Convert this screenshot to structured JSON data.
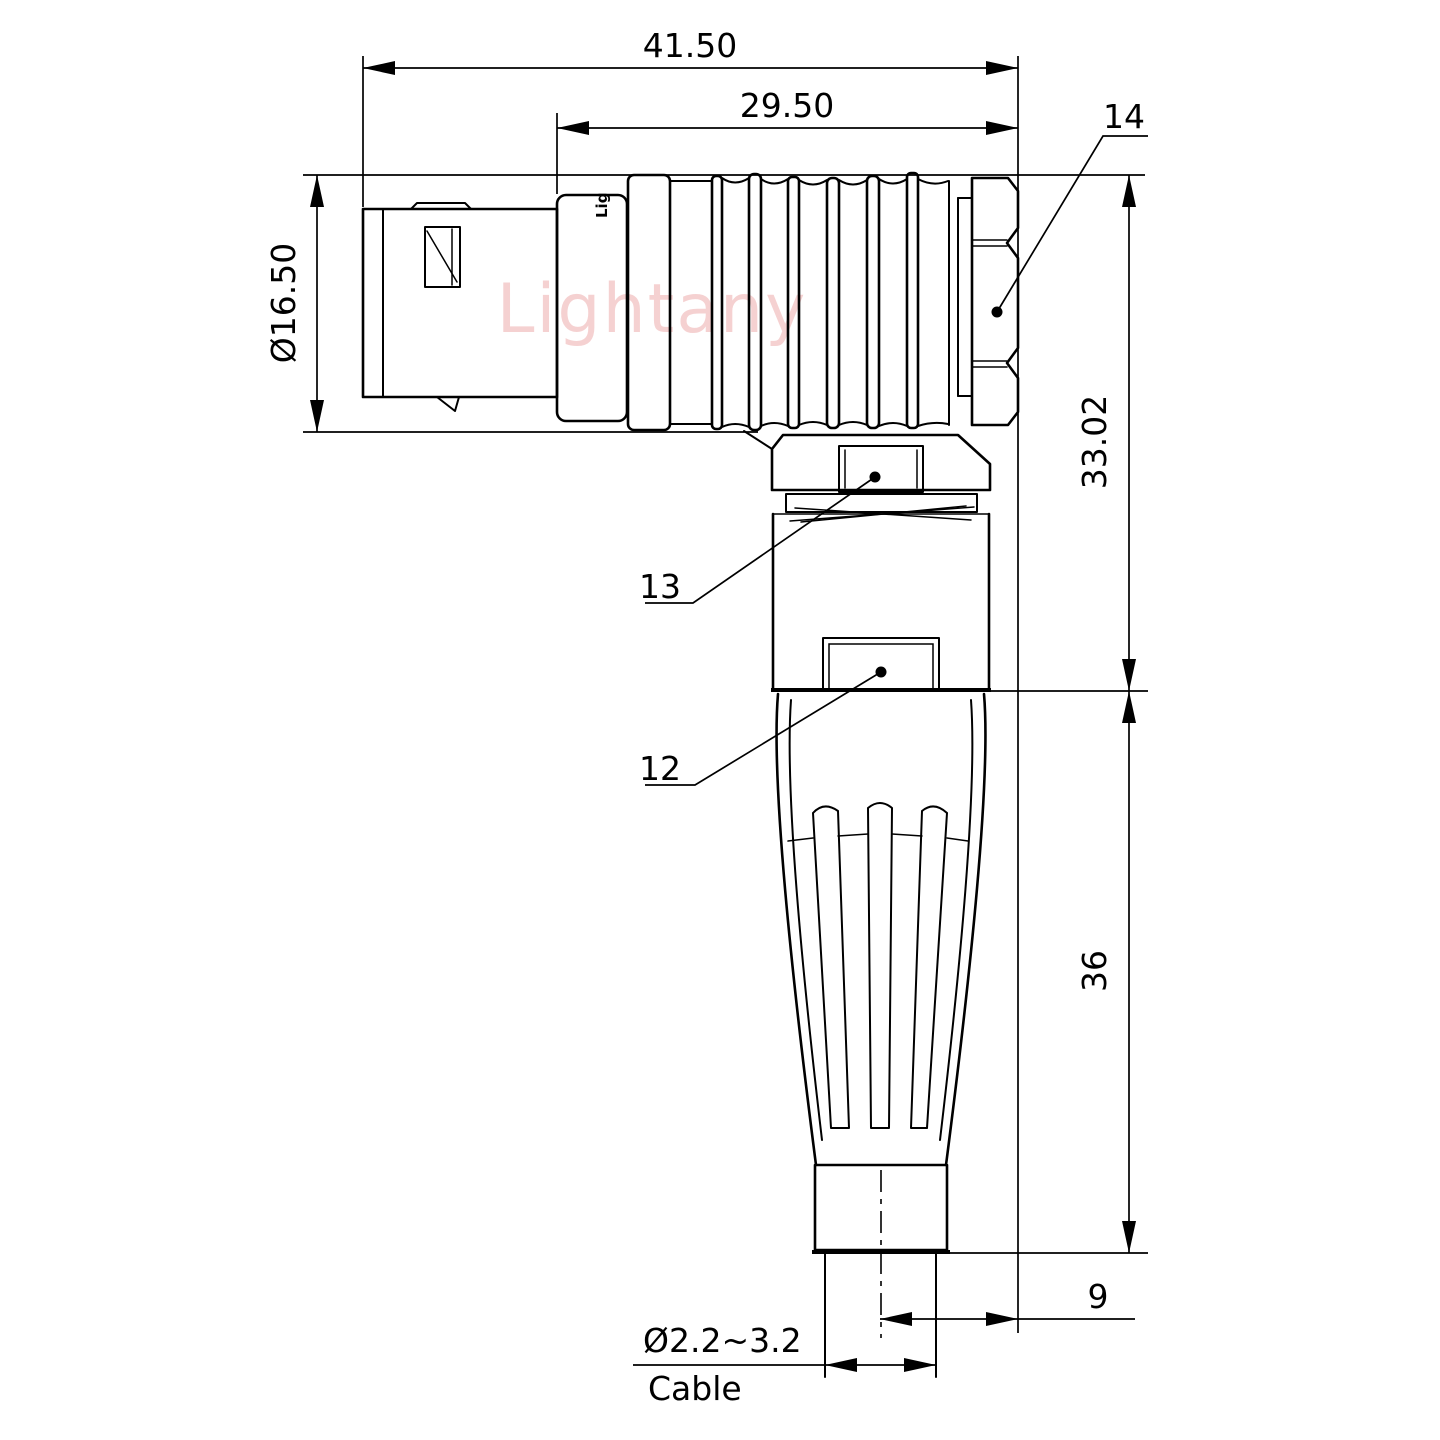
{
  "watermark": {
    "text": "Lightany",
    "color": "#e88f8f"
  },
  "connector": {
    "body_print": "Lig"
  },
  "dimensions": {
    "overall_length": "41.50",
    "body_length": "29.50",
    "shell_diameter": "Ø16.50",
    "elbow_height": "33.02",
    "lower_height": "36",
    "rear_offset": "9",
    "cable_diameter_range": "Ø2.2~3.2",
    "cable_label": "Cable"
  },
  "part_labels": {
    "hex_nut": "14",
    "gland_nut": "13",
    "housing": "12"
  }
}
